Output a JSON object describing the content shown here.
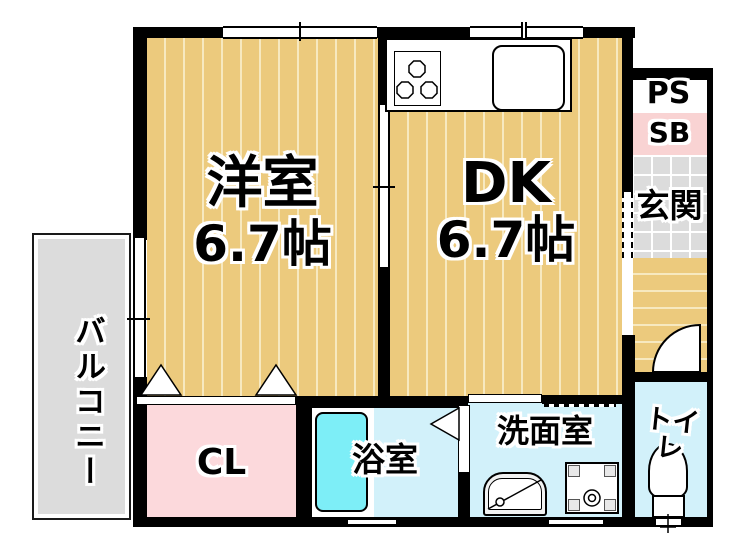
{
  "rooms": {
    "western_room": {
      "name": "洋室",
      "size": "6.7帖"
    },
    "dining_kitchen": {
      "name": "DK",
      "size": "6.7帖"
    },
    "balcony": {
      "name": "バルコニー"
    },
    "closet": {
      "name": "CL"
    },
    "bath": {
      "name": "浴室"
    },
    "washroom": {
      "name": "洗面室"
    },
    "toilet": {
      "name": "トイレ"
    },
    "entrance": {
      "name": "玄関"
    },
    "pipe_space": {
      "name": "PS"
    },
    "shoe_box": {
      "name": "SB"
    }
  },
  "colors": {
    "wall": "#000000",
    "floor_tan": "#ecca7d",
    "floor_stripe": "#f7e9c0",
    "room_cyan": "#d2f1fa",
    "tub_cyan": "#7deef7",
    "closet_pink": "#fcd9dc",
    "sb_pink": "#f9d3d3",
    "tile_gray": "#dcdcdc",
    "balcony_gray": "#dcdcdc"
  }
}
